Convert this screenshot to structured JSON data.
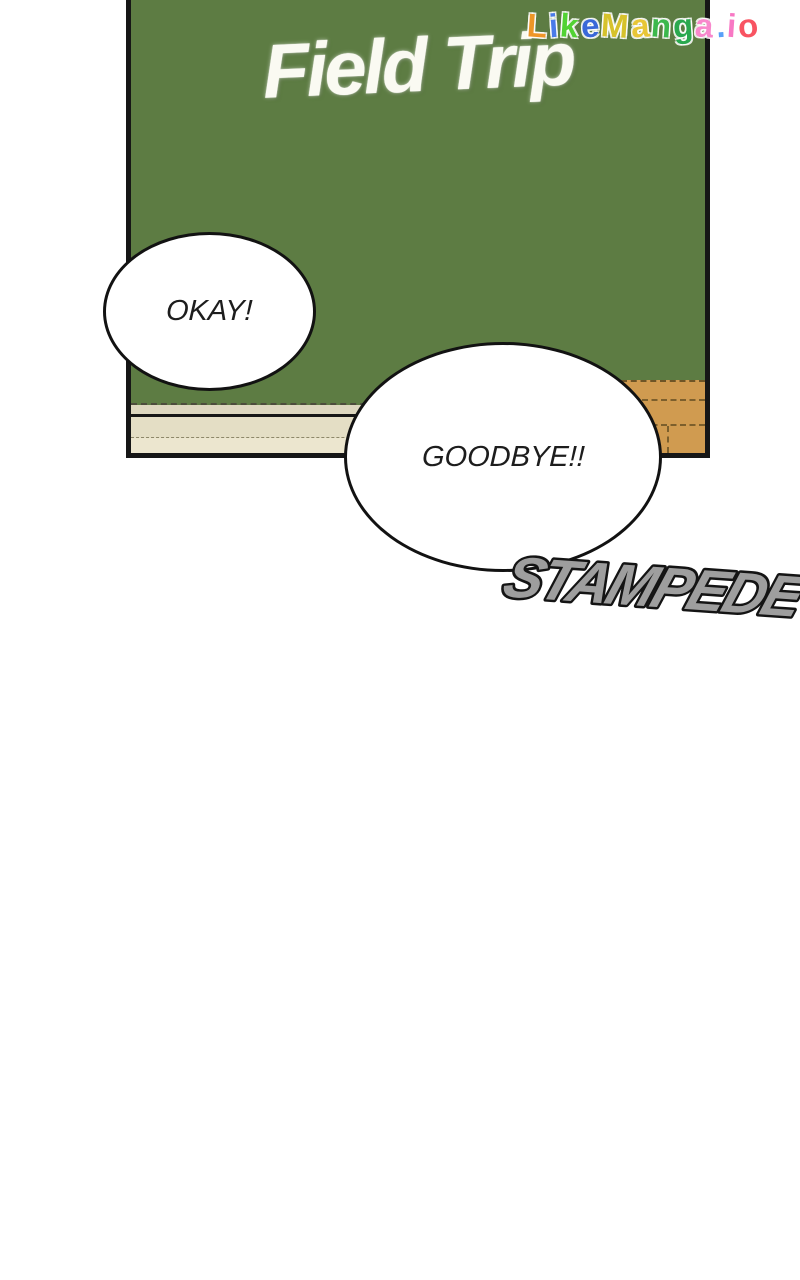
{
  "panel": {
    "board_title": "Field Trip"
  },
  "bubbles": {
    "okay": "OKAY!",
    "goodbye": "GOODBYE!!"
  },
  "sfx": {
    "text": "STAMPEDE"
  },
  "watermark": {
    "text": "LikeManga.io",
    "letters": [
      {
        "ch": "L",
        "color": "#ee9628"
      },
      {
        "ch": "i",
        "color": "#4a7ae8"
      },
      {
        "ch": "k",
        "color": "#52d234"
      },
      {
        "ch": "e",
        "color": "#3a68d8"
      },
      {
        "ch": "M",
        "color": "#d6c22c"
      },
      {
        "ch": "a",
        "color": "#e8c636"
      },
      {
        "ch": "n",
        "color": "#3cb84c"
      },
      {
        "ch": "g",
        "color": "#2aa84e"
      },
      {
        "ch": "a",
        "color": "#f888cc"
      },
      {
        "ch": ".",
        "color": "#58a0f8"
      },
      {
        "ch": "i",
        "color": "#f878c4"
      },
      {
        "ch": "o",
        "color": "#f85462"
      }
    ]
  },
  "colors": {
    "page_bg": "#ffffff",
    "board_green": "#5d7c43",
    "panel_border": "#161616",
    "chalk_white": "#fafaf2",
    "tray_top": "#ddd7bf",
    "tray_mid": "#e4dec5",
    "tray_light": "#ece6cf",
    "tray_dash": "#4c4c3c",
    "tray_thin_dash": "#8d8769",
    "wood": "#d09b50",
    "wood_seam": "#6e5526",
    "bubble_bg": "#ffffff",
    "bubble_border": "#121212",
    "text_dark": "#1d1d1d",
    "sfx_fill": "#9e9e9e",
    "sfx_outline": "#141414"
  }
}
